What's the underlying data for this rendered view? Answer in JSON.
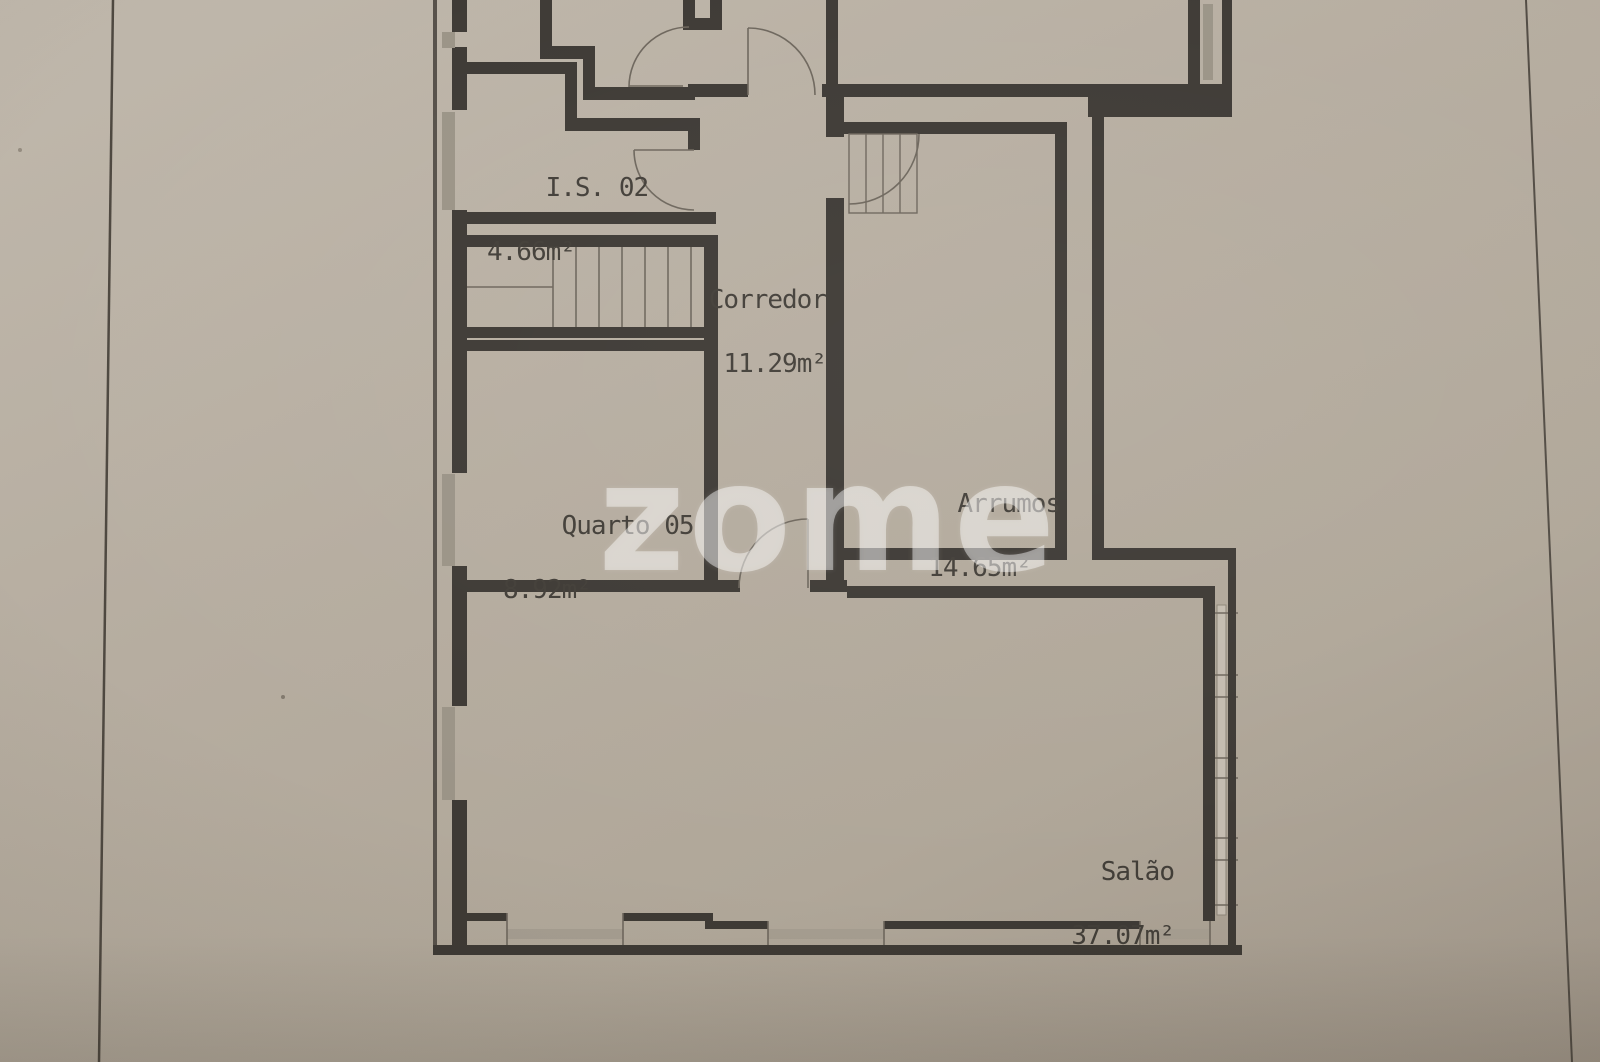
{
  "document": {
    "kind": "floor-plan photo",
    "watermark": "zome"
  },
  "rooms": [
    {
      "name": "I.S. 02",
      "area": "4.66m²"
    },
    {
      "name": "Corredor",
      "area": "11.29m²"
    },
    {
      "name": "Quarto 05",
      "area": "8.92m²"
    },
    {
      "name": "Arrumos",
      "area": "14.65m²"
    },
    {
      "name": "Salão",
      "area": "37.07m²"
    }
  ],
  "colors": {
    "paper": "#b3aa9d",
    "wall": "#3e3a35",
    "thin_line": "#6e675d",
    "glazing": "#c4bcb0",
    "text": "#423e38",
    "watermark": "rgba(255,255,255,0.44)"
  }
}
